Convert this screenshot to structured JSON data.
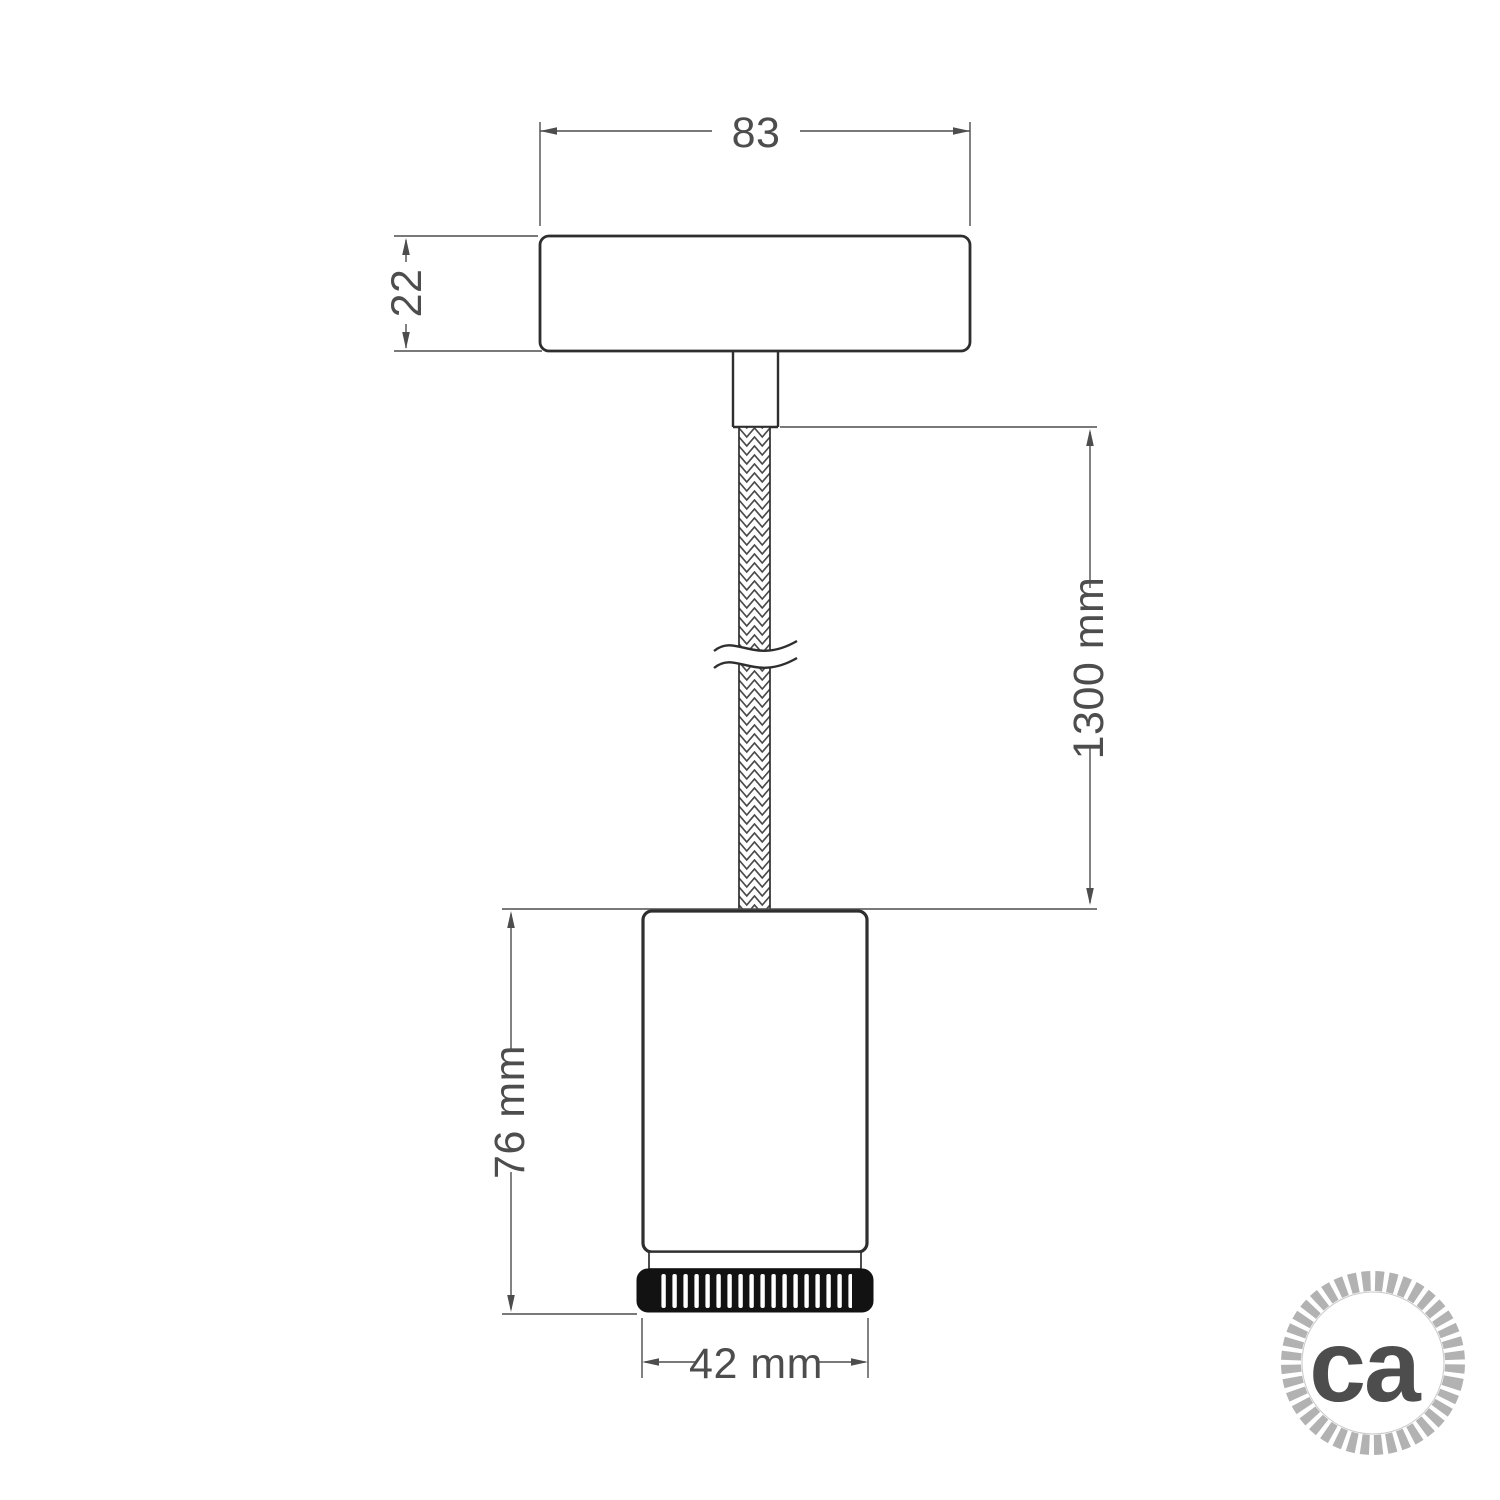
{
  "drawing": {
    "description": "Pendant spotlight lamp dimensional technical drawing",
    "labels": {
      "canopy_width": "83",
      "canopy_height": "22",
      "cable_length": "1300 mm",
      "spotlight_height": "76 mm",
      "spotlight_diameter": "42 mm"
    },
    "logo_text": "ca",
    "colors": {
      "outline": "#2e2e2e",
      "dimension_line": "#4d4d4d",
      "ring_fill": "#121212",
      "logo_gray": "#ababab",
      "background": "#ffffff"
    }
  }
}
